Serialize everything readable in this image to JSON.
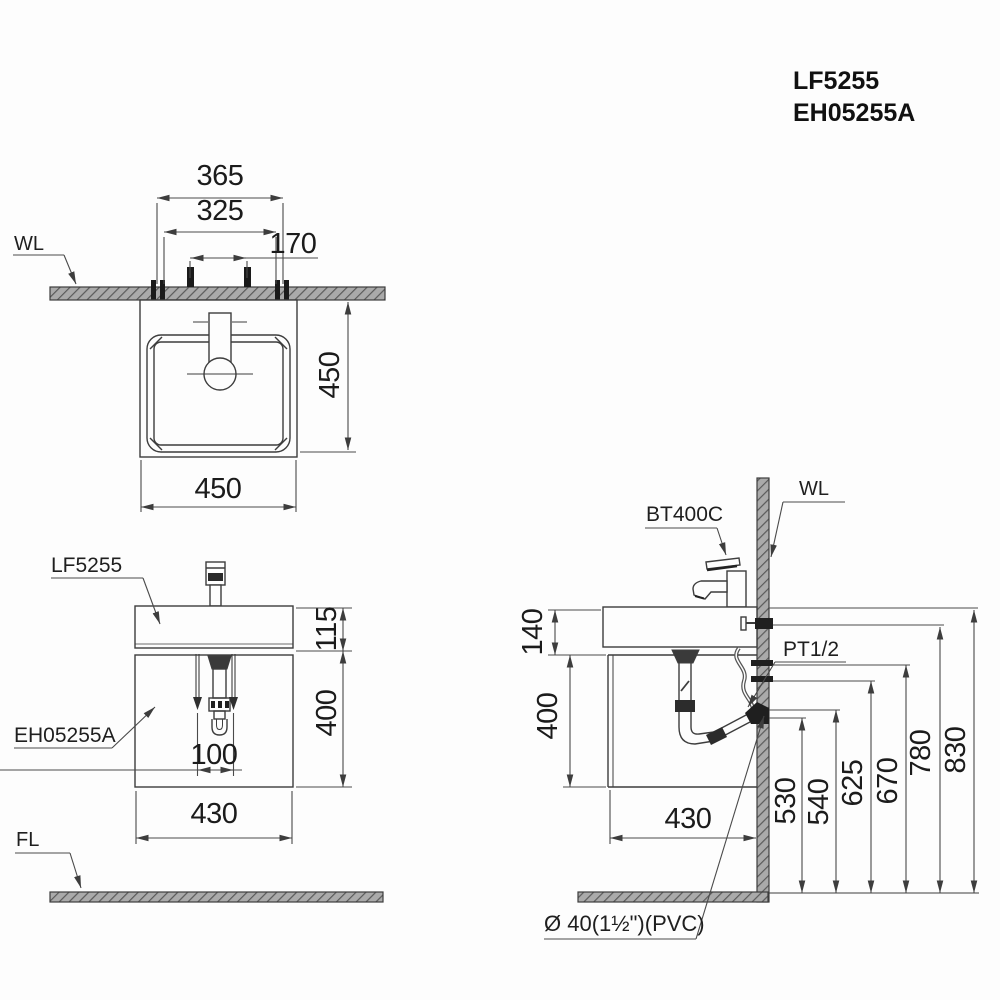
{
  "drawing": {
    "product_codes": [
      "LF5255",
      "EH05255A"
    ],
    "line_color": "#3d3d3d",
    "text_color": "#1f1f1f"
  },
  "top_view": {
    "wall_label": "WL",
    "dim_365": "365",
    "dim_325": "325",
    "dim_170": "170",
    "dim_depth": "450",
    "dim_width": "450"
  },
  "front_view": {
    "basin_label": "LF5255",
    "cabinet_label": "EH05255A",
    "floor_label": "FL",
    "dim_basin_height": "115",
    "dim_cabinet_height": "400",
    "dim_drain_spacing": "100",
    "dim_cabinet_width": "430"
  },
  "side_view": {
    "faucet_label": "BT400C",
    "wall_label": "WL",
    "supply_label": "PT1/2",
    "drain_note": "Ø 40(1½\")(PVC)",
    "dim_140": "140",
    "dim_400": "400",
    "dim_430": "430",
    "dim_530": "530",
    "dim_540": "540",
    "dim_625": "625",
    "dim_670": "670",
    "dim_780": "780",
    "dim_830": "830"
  }
}
